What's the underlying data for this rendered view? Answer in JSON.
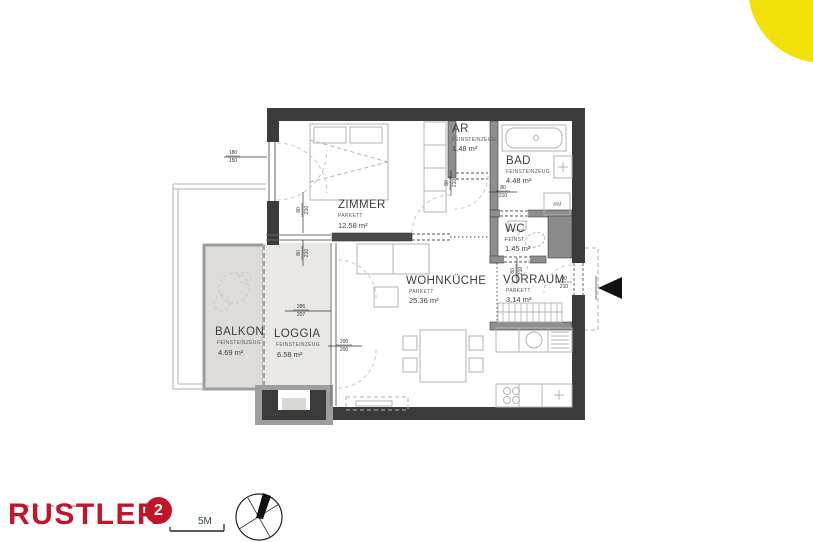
{
  "branding": {
    "logo_text": "RUSTLER",
    "logo_badge": "2",
    "scale_label": "5M"
  },
  "rooms": {
    "zimmer": {
      "name": "ZIMMER",
      "floor": "PARKETT",
      "area": "12.58 m²"
    },
    "ar": {
      "name": "AR",
      "floor": "FEINSTEINZEUG",
      "area": "1.48 m²"
    },
    "bad": {
      "name": "BAD",
      "floor": "FEINSTEINZEUG",
      "area": "4.48 m²"
    },
    "wc": {
      "name": "WC",
      "floor": "FEINST.",
      "area": "1.45 m²"
    },
    "vorraum": {
      "name": "VORRAUM",
      "floor": "PARKETT",
      "area": "3.14 m²"
    },
    "wohnkueche": {
      "name": "WOHNKÜCHE",
      "floor": "PARKETT",
      "area": "25.36 m²"
    },
    "balkon": {
      "name": "BALKON",
      "floor": "FEINSTEINZEUG",
      "area": "4.69 m²"
    },
    "loggia": {
      "name": "LOGGIA",
      "floor": "FEINSTEINZEUG",
      "area": "6.58 m²"
    }
  },
  "fixtures": {
    "washing_machine": "WM"
  },
  "dimensions": {
    "zimmer_window": {
      "w": "180",
      "h": "150"
    },
    "zimmer_loggia_door": {
      "w": "80",
      "h": "210"
    },
    "loggia_glazing": {
      "w": "286",
      "h": "207"
    },
    "kueche_glazing": {
      "w": "200",
      "h": "200"
    },
    "ar_door": {
      "w": "80",
      "h": "210"
    },
    "bad_door": {
      "w": "80",
      "h": "210"
    },
    "wc_door": {
      "w": "80",
      "h": "210"
    },
    "entrance_door": {
      "w": "90",
      "h": "210"
    }
  },
  "colors": {
    "wall_dark": "#3b3b3b",
    "wall_mid": "#8f8f8f",
    "balcony_fill": "#dddcd9",
    "loggia_fill": "#e9e8e5",
    "brand_red": "#C2152B",
    "accent_yellow": "#F2E00A"
  }
}
